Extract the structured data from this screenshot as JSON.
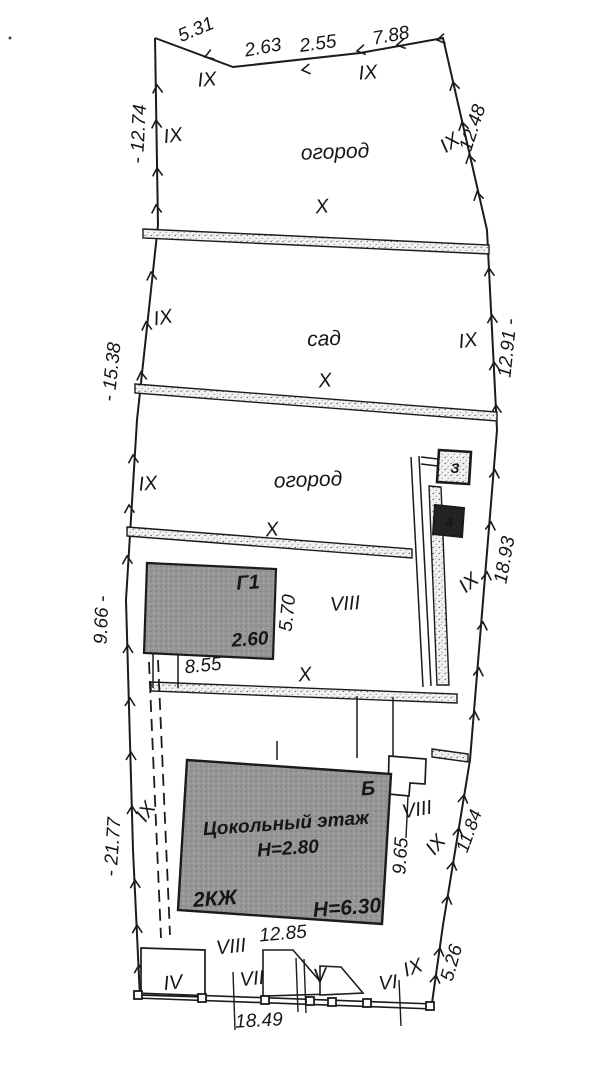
{
  "plan": {
    "areas": {
      "garden_upper": "огород",
      "orchard": "сад",
      "garden_lower": "огород",
      "ix": "IX",
      "x": "X",
      "viii": "VIII",
      "vii": "VII",
      "vi": "VI",
      "v": "V",
      "iv": "IV"
    },
    "buildings": {
      "main_letter": "Б",
      "main_floor": "Цокольный этаж",
      "main_basement_h": "Н=2.80",
      "main_storeys": "2КЖ",
      "main_height": "Н=6.30",
      "g1_letter": "Г1",
      "g1_height": "2.60",
      "shed_3": "З",
      "shed_4": "4"
    },
    "dims": {
      "top_1": "5.31",
      "top_2": "2.63",
      "top_3": "2.55",
      "top_4": "7.88",
      "left_1": "- 12.74",
      "left_2": "- 15.38",
      "left_3": "9.66 -",
      "left_4": "- 21.77",
      "right_1": "12.48",
      "right_2": "12.91 -",
      "right_3": "18.93",
      "right_4": "11.84",
      "right_5": "5.26",
      "g1_w": "8.55",
      "g1_d": "5.70",
      "house_w": "12.85",
      "house_d": "9.65",
      "bottom": "18.49"
    }
  }
}
